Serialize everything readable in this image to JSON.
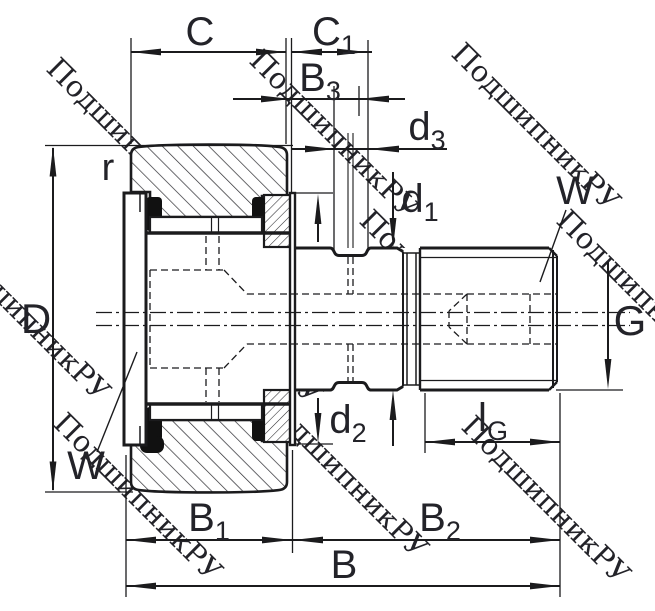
{
  "drawing": {
    "kind": "bearing-cross-section-technical-drawing",
    "watermark": {
      "text": "ПодшипникРУ"
    },
    "labels": {
      "c": {
        "main": "C",
        "sub": ""
      },
      "c1": {
        "main": "C",
        "sub": "1"
      },
      "b3": {
        "main": "B",
        "sub": "3"
      },
      "d3": {
        "main": "d",
        "sub": "3"
      },
      "d1": {
        "main": "d",
        "sub": "1"
      },
      "d2": {
        "main": "d",
        "sub": "2"
      },
      "r": {
        "main": "r"
      },
      "D": {
        "main": "D"
      },
      "w_top": {
        "main": "W"
      },
      "w_bottom": {
        "main": "W"
      },
      "g": {
        "main": "G"
      },
      "lg": {
        "main": "l",
        "sub": "G"
      },
      "b1": {
        "main": "B",
        "sub": "1"
      },
      "b2": {
        "main": "B",
        "sub": "2"
      },
      "b": {
        "main": "B"
      }
    },
    "colors": {
      "line": "#1b1b1d",
      "label": "#232329",
      "hatch": "#2b2b2f",
      "seal": "#111111",
      "watermark": "rgba(125,125,125,0.38)"
    }
  }
}
